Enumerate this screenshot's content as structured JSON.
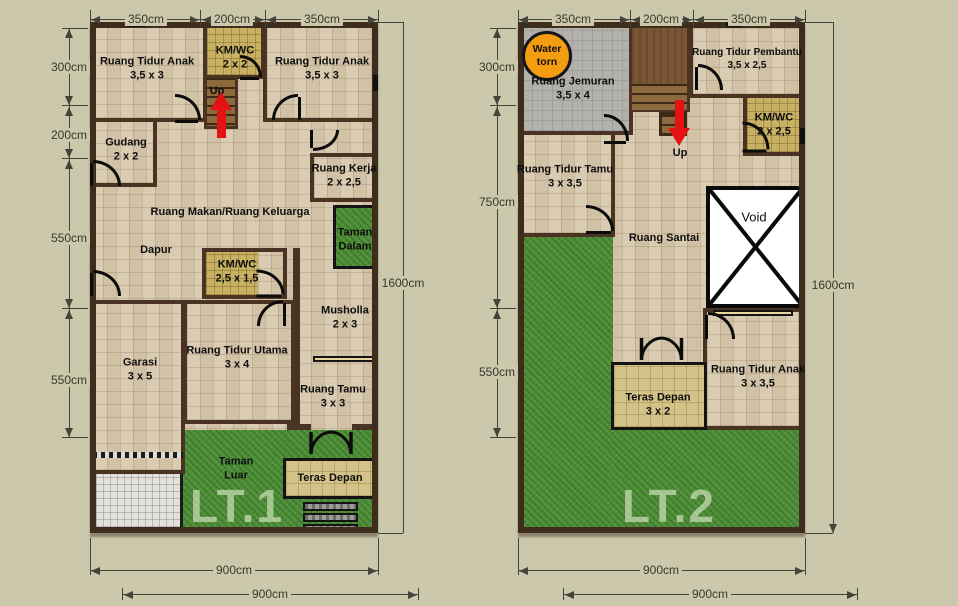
{
  "colors": {
    "background": "#cbc8ac",
    "wall": "#3e2d1c",
    "floor_tile": "#d9ccb2",
    "bath_tile": "#c9b164",
    "grass": "#4f8f38",
    "wood_stairs": "#8d6a3e",
    "laundry_floor": "#b3b1ac",
    "terrace_floor": "#d4c388",
    "driveway": "#e3e1db",
    "water_tank_orange": "#f49c12",
    "direction_arrow_red": "#e41212",
    "dimension_text": "#39382e"
  },
  "floor1": {
    "label": "LT.1",
    "dims": {
      "top": [
        "350cm",
        "200cm",
        "350cm"
      ],
      "left": [
        "300cm",
        "200cm",
        "550cm",
        "550cm"
      ],
      "right": "1600cm",
      "bottom": [
        "900cm",
        "900cm"
      ]
    },
    "rooms": {
      "bedroom_child_left": {
        "name": "Ruang Tidur Anak",
        "size": "3,5 x 3"
      },
      "bathroom_top": {
        "name": "KM/WC",
        "size": "2 x 2"
      },
      "stairs_up": "Up",
      "bedroom_child_right": {
        "name": "Ruang Tidur Anak",
        "size": "3,5 x 3"
      },
      "storage": {
        "name": "Gudang",
        "size": "2 x 2"
      },
      "workroom": {
        "name": "Ruang Kerja",
        "size": "2 x 2,5"
      },
      "dining_family": {
        "name": "Ruang Makan/Ruang Keluarga"
      },
      "inner_garden": {
        "name": "Taman Dalam"
      },
      "kitchen": {
        "name": "Dapur"
      },
      "bathroom_mid": {
        "name": "KM/WC",
        "size": "2,5 x 1,5"
      },
      "prayer_room": {
        "name": "Musholla",
        "size": "2 x 3"
      },
      "garage": {
        "name": "Garasi",
        "size": "3 x 5"
      },
      "master_bedroom": {
        "name": "Ruang Tidur Utama",
        "size": "3 x 4"
      },
      "living_room": {
        "name": "Ruang Tamu",
        "size": "3 x 3"
      },
      "outer_garden": {
        "name": "Taman Luar"
      },
      "front_terrace": {
        "name": "Teras Depan"
      }
    }
  },
  "floor2": {
    "label": "LT.2",
    "dims": {
      "top": [
        "350cm",
        "200cm",
        "350cm"
      ],
      "left": [
        "300cm",
        "750cm",
        "550cm"
      ],
      "right": "1600cm",
      "bottom": [
        "900cm",
        "900cm"
      ]
    },
    "rooms": {
      "water_tank": {
        "name": "Water torn"
      },
      "laundry": {
        "name": "Ruang Jemuran",
        "size": "3,5 x 4"
      },
      "stairs_up": "Up",
      "maid_bedroom": {
        "name": "Ruang Tidur Pembantu",
        "size": "3,5 x 2,5"
      },
      "bathroom": {
        "name": "KM/WC",
        "size": "2 x 2,5"
      },
      "guest_bedroom": {
        "name": "Ruang Tidur Tamu",
        "size": "3 x 3,5"
      },
      "lounge": {
        "name": "Ruang Santai"
      },
      "void": {
        "name": "Void"
      },
      "child_bedroom": {
        "name": "Ruang Tidur Anak",
        "size": "3 x 3,5"
      },
      "front_terrace": {
        "name": "Teras Depan",
        "size": "3 x 2"
      }
    }
  }
}
